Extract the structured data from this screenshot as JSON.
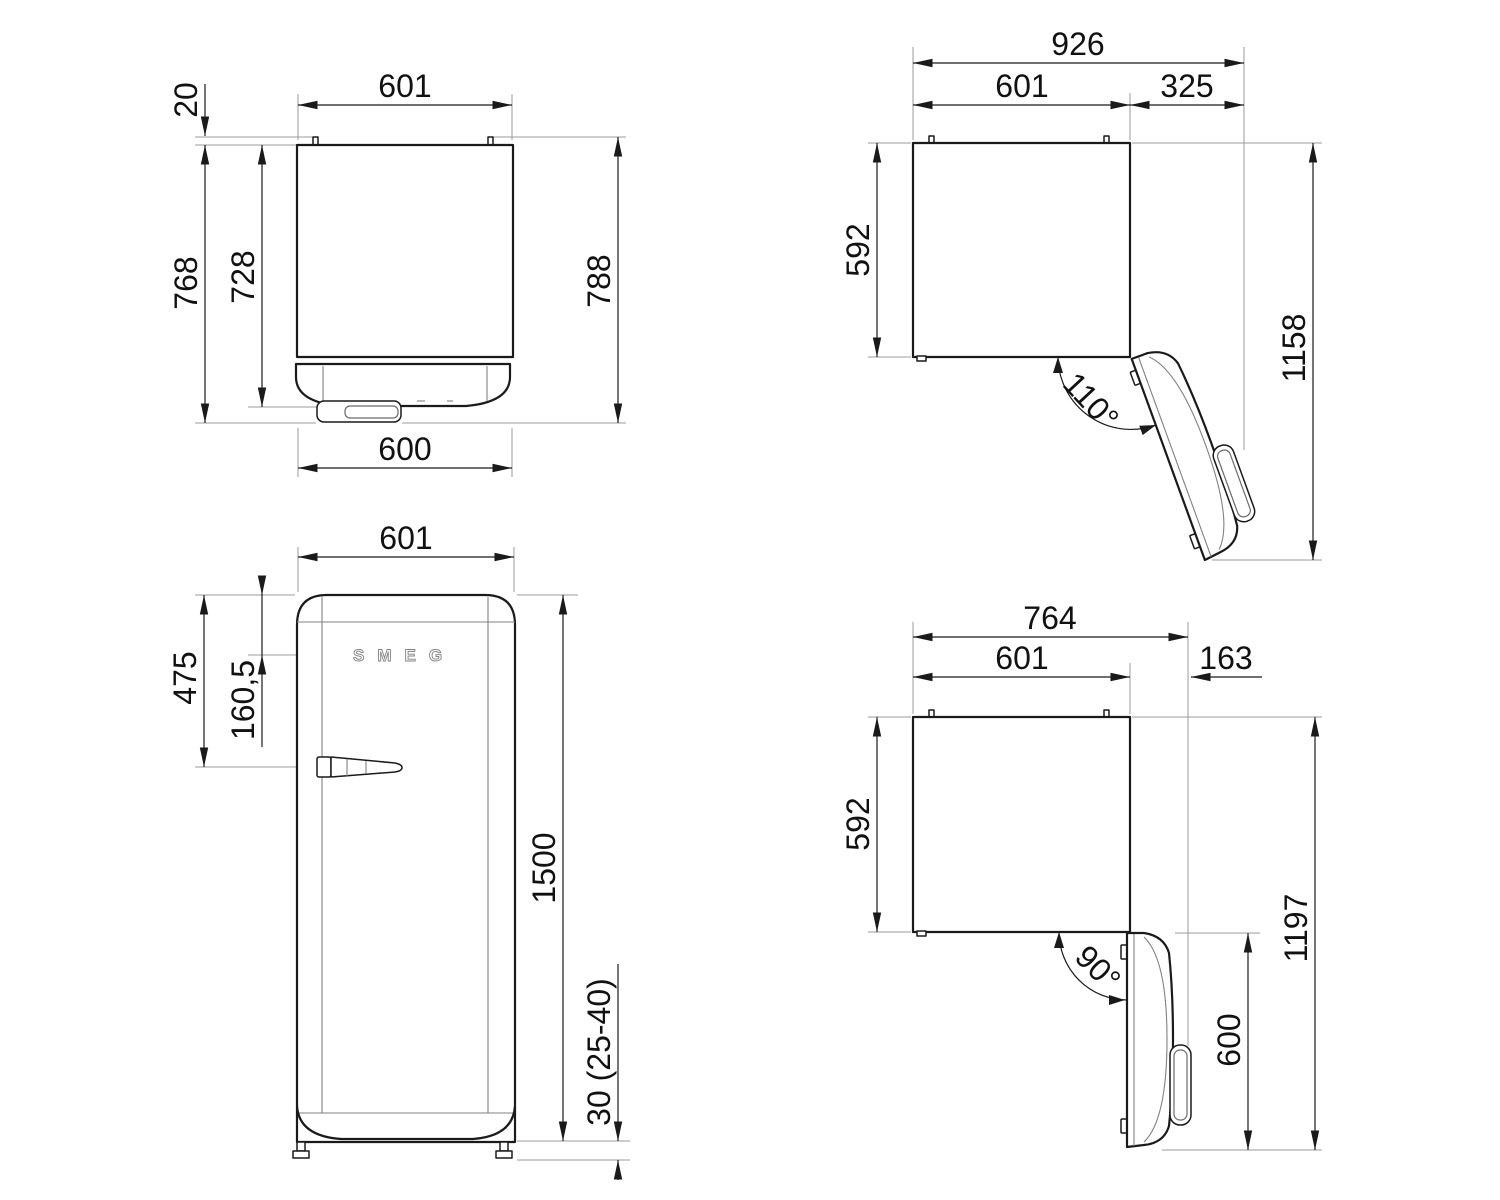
{
  "views": {
    "top_closed": {
      "dims": {
        "width": "601",
        "spacer": "20",
        "depth_to_handle": "768",
        "depth_to_door": "728",
        "depth_overall": "788",
        "door_width": "600"
      }
    },
    "top_open110": {
      "dims": {
        "overall_width": "926",
        "width": "601",
        "side_clearance": "325",
        "depth": "592",
        "overall_depth": "1158",
        "angle": "110°"
      }
    },
    "front": {
      "logo_text": "SMEG",
      "dims": {
        "width": "601",
        "top_to_handle": "475",
        "top_to_logo": "160,5",
        "height": "1500",
        "feet_height": "30 (25-40)"
      }
    },
    "top_open90": {
      "dims": {
        "overall_width": "764",
        "width": "601",
        "side_clearance": "163",
        "depth": "592",
        "overall_depth": "1197",
        "door_width": "600",
        "angle": "90°"
      }
    }
  }
}
